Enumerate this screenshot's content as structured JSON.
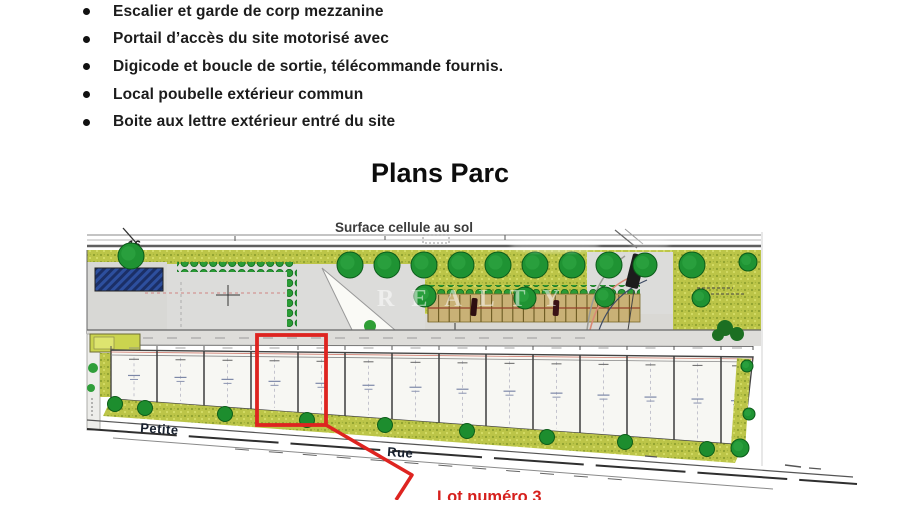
{
  "document": {
    "bullet_items": [
      "Escalier et garde de corp mezzanine",
      "Portail d’accès du site motorisé avec",
      "Digicode et boucle de sortie, télécommande fournis.",
      "Local poubelle extérieur commun",
      "Boite aux lettre extérieur entré du site"
    ],
    "heading": "Plans Parc"
  },
  "plan": {
    "caption": "Surface cellule au sol",
    "road_number": "16",
    "street_left": "Petite",
    "street_right": "Rue",
    "watermark": "REALTY",
    "callout": "Lot numéro 3",
    "colors": {
      "highlight_red": "#de2420",
      "grass_green": "#bcc548",
      "tree_green": "#1f9333",
      "parking_tan": "#c9b176",
      "plan_blue": "#2d4f9e"
    }
  }
}
